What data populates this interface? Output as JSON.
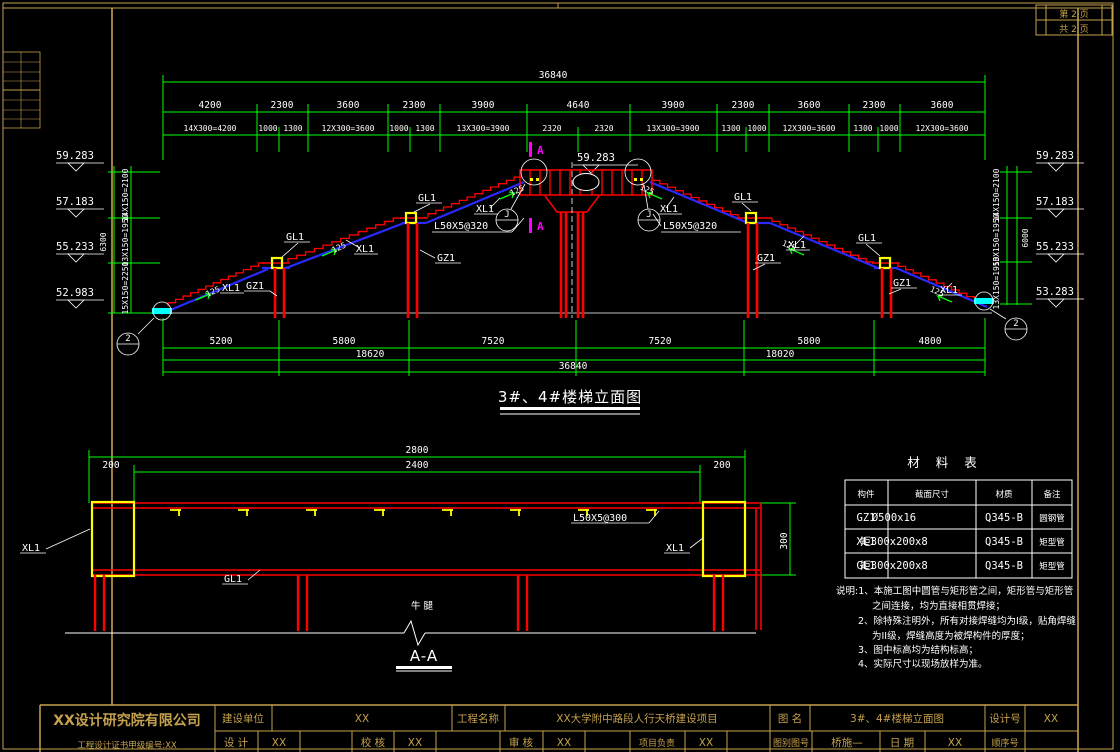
{
  "colors": {
    "background": "#000000",
    "frame_gold": "#C5A14E",
    "dim_green": "#00FF00",
    "steel_red": "#FF0000",
    "stringer_blue": "#2A2AFF",
    "beam_yellow": "#FFFF00",
    "bearing_cyan": "#00FFFF",
    "cut_magenta": "#FF00FF",
    "text_white": "#FFFFFF"
  },
  "page_corner": {
    "row1": "第 2 页",
    "row2": "共 2 页"
  },
  "elevation": {
    "title": "3#、4#楼梯立面图",
    "top_dims": {
      "total": "36840",
      "segments": [
        "4200",
        "2300",
        "3600",
        "2300",
        "3900",
        "4640",
        "3900",
        "2300",
        "3600",
        "2300",
        "3600"
      ],
      "subsegments": [
        "14X300=4200",
        "1000",
        "1300",
        "12X300=3600",
        "1000",
        "1300",
        "13X300=3900",
        "2320",
        "2320",
        "13X300=3900",
        "1300",
        "1000",
        "12X300=3600",
        "1300",
        "1000",
        "12X300=3600"
      ]
    },
    "bottom_dims": {
      "segments": [
        "5200",
        "5800",
        "7520",
        "7520",
        "5800",
        "4800"
      ],
      "subtotals": [
        "18620",
        "18020"
      ],
      "total": "36840"
    },
    "levels_left": [
      "59.283",
      "57.183",
      "55.233",
      "52.983"
    ],
    "levels_right": [
      "59.283",
      "57.183",
      "55.233",
      "53.283"
    ],
    "level_apex": "59.283",
    "vdim_left": {
      "total": "6300",
      "segments": [
        "14X150=2100",
        "13X150=1950",
        "15X150=2250"
      ]
    },
    "vdim_right": {
      "total": "6000",
      "segments": [
        "14X150=2100",
        "13X150=1950",
        "13X150=1950"
      ]
    },
    "labels": {
      "gl1": "GL1",
      "xl1": "XL1",
      "gz1": "GZ1",
      "angle320": "L50X5@320",
      "slope": "125",
      "cut_a": "A",
      "detail_end": "2",
      "detail_mid": "J"
    }
  },
  "section_aa": {
    "title": "A-A",
    "dim_total": "2800",
    "dim_inner": "2400",
    "dim_side_left": "200",
    "dim_side_right": "200",
    "dim_height": "300",
    "label_xl1": "XL1",
    "label_gl1": "GL1",
    "label_angle": "L50X5@300",
    "label_corbel": "牛 腿"
  },
  "material_table": {
    "title": "材 料 表",
    "headers": [
      "构件",
      "截面尺寸",
      "材质",
      "备注"
    ],
    "rows": [
      {
        "member": "GZ1",
        "size": "Ø500x16",
        "grade": "Q345-B",
        "note": "圆钢管"
      },
      {
        "member": "XL1",
        "size": "矩300x200x8",
        "grade": "Q345-B",
        "note": "矩型管"
      },
      {
        "member": "GL1",
        "size": "矩300x200x8",
        "grade": "Q345-B",
        "note": "矩型管"
      }
    ]
  },
  "notes": {
    "l1": "说明:1、本施工图中圆管与矩形管之间，矩形管与矩形管",
    "l2": "之间连接，均为直接相贯焊接；",
    "l3": "2、除特殊注明外，所有对接焊缝均为I级，贴角焊缝",
    "l4": "为II级，焊缝高度为被焊构件的厚度；",
    "l5": "3、图中标高均为结构标高；",
    "l6": "4、实际尺寸以现场放样为准。"
  },
  "title_block": {
    "company": "XX设计研究院有限公司",
    "company_sub": "工程设计证书甲级编号:XX",
    "jsdw_label": "建设单位",
    "jsdw_value": "XX",
    "gcmc_label": "工程名称",
    "gcmc_value": "XX大学附中路段人行天桥建设项目",
    "tm_label": "图 名",
    "tm_value": "3#、4#楼梯立面图",
    "sjh_label": "设计号",
    "sjh_value": "XX",
    "sj_label": "设 计",
    "sj_value": "XX",
    "jh_label": "校 核",
    "jh_value": "XX",
    "sh_label": "审 核",
    "sh_value": "XX",
    "xmfz_label": "项目负责",
    "xmfz_value": "XX",
    "tbth_label": "图别图号",
    "tbth_value": "桥施—",
    "rq_label": "日 期",
    "rq_value": "XX",
    "sxh_label": "顺序号",
    "sxh_value": ""
  }
}
